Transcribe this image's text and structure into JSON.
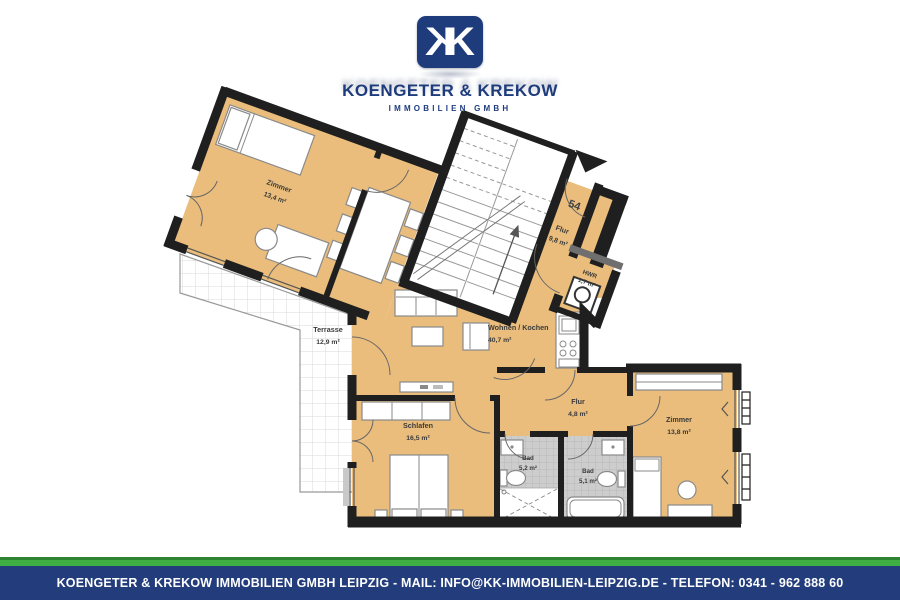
{
  "branding": {
    "monogram_letter": "K",
    "company_name": "KOENGETER & KREKOW",
    "company_subtitle": "IMMOBILIEN GMBH",
    "navy_color": "#1e3c7c",
    "green_color": "#3fae43"
  },
  "floorplan": {
    "unit_number": "54",
    "floor_color": "#eabd7c",
    "wall_color": "#1f1f1f",
    "tile_color": "#cdcdcd",
    "rooms": [
      {
        "name": "Zimmer",
        "area": "13,4 m²"
      },
      {
        "name": "Flur",
        "area": "9,8 m²"
      },
      {
        "name": "HWR",
        "area": "1,7 m²"
      },
      {
        "name": "Wohnen / Kochen",
        "area": "40,7 m²"
      },
      {
        "name": "Terrasse",
        "area": "12,9 m²"
      },
      {
        "name": "Schlafen",
        "area": "16,5 m²"
      },
      {
        "name": "Flur",
        "area": "4,8 m²"
      },
      {
        "name": "Bad",
        "area": "5,2 m²"
      },
      {
        "name": "Bad",
        "area": "5,1 m²"
      },
      {
        "name": "Zimmer",
        "area": "13,8 m²"
      }
    ]
  },
  "footer": {
    "text": "KOENGETER & KREKOW IMMOBILIEN GMBH LEIPZIG - MAIL: INFO@KK-IMMOBILIEN-LEIPZIG.DE - TELEFON: 0341 - 962 888 60"
  }
}
